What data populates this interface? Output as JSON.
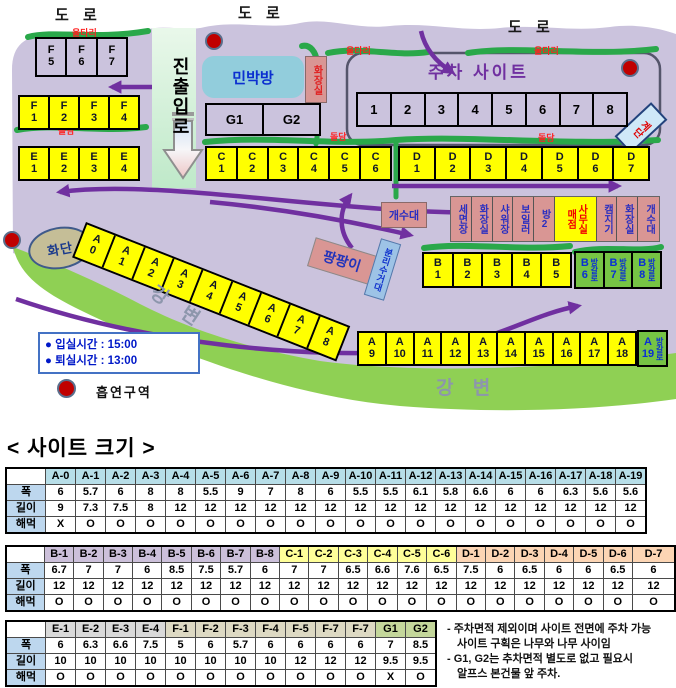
{
  "map": {
    "roads": [
      "도 로",
      "도 로",
      "도 로"
    ],
    "fences": [
      "울타리",
      "울타리",
      "울타리"
    ],
    "walls": [
      "돌담",
      "돌담",
      "돌담"
    ],
    "entrance": "진출입로",
    "guesthouse": "민박방",
    "toilet_small": "화장실",
    "parking_title": "주차 사이트",
    "stairs": "계단",
    "flowerbed": "화단",
    "river": [
      "강 변",
      "강 변"
    ],
    "sink": "개수대",
    "bouncer": "팡팡이",
    "recycle": "분리수거대",
    "legend": {
      "checkin": "● 입실시간 : 15:00",
      "checkout": "● 퇴실시간 : 13:00",
      "smoking": "흡연구역"
    },
    "rows": {
      "f_top": [
        {
          "l": "F",
          "n": "5"
        },
        {
          "l": "F",
          "n": "6"
        },
        {
          "l": "F",
          "n": "7"
        }
      ],
      "f": [
        {
          "l": "F",
          "n": "1"
        },
        {
          "l": "F",
          "n": "2"
        },
        {
          "l": "F",
          "n": "3"
        },
        {
          "l": "F",
          "n": "4"
        }
      ],
      "e": [
        {
          "l": "E",
          "n": "1"
        },
        {
          "l": "E",
          "n": "2"
        },
        {
          "l": "E",
          "n": "3"
        },
        {
          "l": "E",
          "n": "4"
        }
      ],
      "c": [
        {
          "l": "C",
          "n": "1"
        },
        {
          "l": "C",
          "n": "2"
        },
        {
          "l": "C",
          "n": "3"
        },
        {
          "l": "C",
          "n": "4"
        },
        {
          "l": "C",
          "n": "5"
        },
        {
          "l": "C",
          "n": "6"
        }
      ],
      "d": [
        {
          "l": "D",
          "n": "1"
        },
        {
          "l": "D",
          "n": "2"
        },
        {
          "l": "D",
          "n": "3"
        },
        {
          "l": "D",
          "n": "4"
        },
        {
          "l": "D",
          "n": "5"
        },
        {
          "l": "D",
          "n": "6"
        },
        {
          "l": "D",
          "n": "7"
        }
      ],
      "g": [
        {
          "n": "G1"
        },
        {
          "n": "G2"
        }
      ],
      "parking": [
        {
          "n": "1"
        },
        {
          "n": "2"
        },
        {
          "n": "3"
        },
        {
          "n": "4"
        },
        {
          "n": "5"
        },
        {
          "n": "6"
        },
        {
          "n": "7"
        },
        {
          "n": "8"
        }
      ],
      "b": [
        {
          "l": "B",
          "n": "1"
        },
        {
          "l": "B",
          "n": "2"
        },
        {
          "l": "B",
          "n": "3"
        },
        {
          "l": "B",
          "n": "4"
        },
        {
          "l": "B",
          "n": "5"
        }
      ],
      "b_green": [
        {
          "l": "B",
          "n": "6",
          "tag": "방갈로"
        },
        {
          "l": "B",
          "n": "7",
          "tag": "방갈로"
        },
        {
          "l": "B",
          "n": "8",
          "tag": "방갈로"
        }
      ],
      "a_diag": [
        {
          "l": "A",
          "n": "0"
        },
        {
          "l": "A",
          "n": "1"
        },
        {
          "l": "A",
          "n": "2"
        },
        {
          "l": "A",
          "n": "3"
        },
        {
          "l": "A",
          "n": "4"
        },
        {
          "l": "A",
          "n": "5"
        },
        {
          "l": "A",
          "n": "6"
        },
        {
          "l": "A",
          "n": "7"
        },
        {
          "l": "A",
          "n": "8"
        }
      ],
      "a_low": [
        {
          "l": "A",
          "n": "9"
        },
        {
          "l": "A",
          "n": "10"
        },
        {
          "l": "A",
          "n": "11"
        },
        {
          "l": "A",
          "n": "12"
        },
        {
          "l": "A",
          "n": "13"
        },
        {
          "l": "A",
          "n": "14"
        },
        {
          "l": "A",
          "n": "15"
        },
        {
          "l": "A",
          "n": "16"
        },
        {
          "l": "A",
          "n": "17"
        },
        {
          "l": "A",
          "n": "18"
        }
      ],
      "a_green": [
        {
          "l": "A",
          "n": "19",
          "tag": "방갈로"
        }
      ],
      "facilities": [
        {
          "t": "세면장"
        },
        {
          "t": "화장실"
        },
        {
          "t": "샤워장"
        },
        {
          "t": "보일러"
        },
        {
          "t": "방2"
        },
        {
          "cols": [
            "매점",
            "사무실"
          ],
          "accent": true
        },
        {
          "t": "캠지기"
        },
        {
          "t": "화장실"
        },
        {
          "t": "개수대"
        }
      ]
    }
  },
  "sizes": {
    "title": "< 사이트 크기 >",
    "row_labels": [
      "폭",
      "길이",
      "해먹"
    ],
    "tables": [
      {
        "groups": [
          {
            "bg": "#b7dee8",
            "cols": [
              "A-0",
              "A-1",
              "A-2",
              "A-3",
              "A-4",
              "A-5",
              "A-6",
              "A-7",
              "A-8",
              "A-9",
              "A-10",
              "A-11",
              "A-12",
              "A-13",
              "A-14",
              "A-15",
              "A-16",
              "A-17",
              "A-18",
              "A-19"
            ]
          }
        ],
        "rows": [
          [
            6,
            5.7,
            6,
            8,
            8,
            5.5,
            9,
            7,
            8,
            6,
            5.5,
            5.5,
            6.1,
            5.8,
            6.6,
            6,
            6,
            6.3,
            5.6,
            5.6
          ],
          [
            9,
            7.3,
            7.5,
            8,
            12,
            12,
            12,
            12,
            12,
            12,
            12,
            12,
            12,
            12,
            12,
            12,
            12,
            12,
            12,
            12
          ],
          [
            "X",
            "O",
            "O",
            "O",
            "O",
            "O",
            "O",
            "O",
            "O",
            "O",
            "O",
            "O",
            "O",
            "O",
            "O",
            "O",
            "O",
            "O",
            "O",
            "O"
          ]
        ]
      },
      {
        "wide_last": true,
        "groups": [
          {
            "bg": "#ccc0da",
            "cols": [
              "B-1",
              "B-2",
              "B-3",
              "B-4",
              "B-5",
              "B-6",
              "B-7",
              "B-8"
            ]
          },
          {
            "bg": "#ffff99",
            "cols": [
              "C-1",
              "C-2",
              "C-3",
              "C-4",
              "C-5",
              "C-6"
            ]
          },
          {
            "bg": "#fcd5b4",
            "cols": [
              "D-1",
              "D-2",
              "D-3",
              "D-4",
              "D-5",
              "D-6",
              "D-7"
            ]
          }
        ],
        "rows": [
          [
            6.7,
            7,
            7,
            6,
            8.5,
            7.5,
            5.7,
            6,
            7,
            7,
            6.5,
            6.6,
            7.6,
            6.5,
            7.5,
            6,
            6.5,
            6,
            6,
            6.5,
            6
          ],
          [
            12,
            12,
            12,
            12,
            12,
            12,
            12,
            12,
            12,
            12,
            12,
            12,
            12,
            12,
            12,
            12,
            12,
            12,
            12,
            12,
            12
          ],
          [
            "O",
            "O",
            "O",
            "O",
            "O",
            "O",
            "O",
            "O",
            "O",
            "O",
            "O",
            "O",
            "O",
            "O",
            "O",
            "O",
            "O",
            "O",
            "O",
            "O",
            "O"
          ]
        ]
      },
      {
        "groups": [
          {
            "bg": "#d9d9d9",
            "cols": [
              "E-1",
              "E-2",
              "E-3",
              "E-4"
            ]
          },
          {
            "bg": "#ddd9c3",
            "cols": [
              "F-1",
              "F-2",
              "F-3",
              "F-4",
              "F-5",
              "F-7",
              "F-7"
            ]
          },
          {
            "bg": "#c4d79b",
            "cols": [
              "G1",
              "G2"
            ]
          }
        ],
        "rows": [
          [
            6,
            6.3,
            6.6,
            7.5,
            5,
            6,
            5.7,
            6,
            6,
            6,
            6,
            7,
            8.5
          ],
          [
            10,
            10,
            10,
            10,
            10,
            10,
            10,
            10,
            12,
            12,
            12,
            9.5,
            9.5
          ],
          [
            "O",
            "O",
            "O",
            "O",
            "O",
            "O",
            "O",
            "O",
            "O",
            "O",
            "O",
            "X",
            "O"
          ]
        ]
      }
    ],
    "notes": [
      "- 주차면적 제외이며 사이트 전면에 주차 가능",
      "사이트 구획은 나무와 나무 사이임",
      "- G1, G2는 추차면적 별도로 없고 필요시",
      "알프스 본건물 앞 주차."
    ]
  }
}
